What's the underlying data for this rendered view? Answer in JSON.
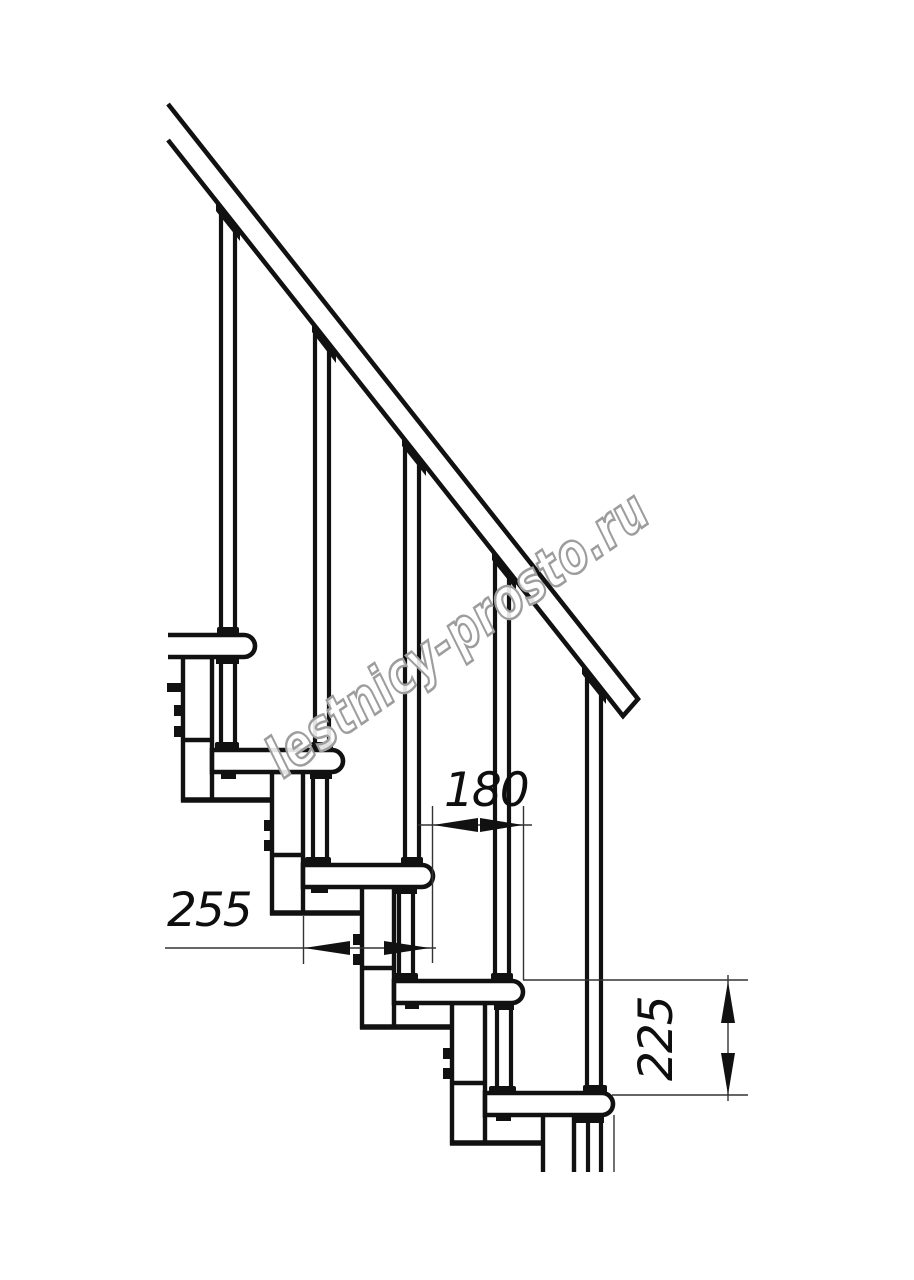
{
  "drawing": {
    "watermark": "lestnicy-prosto.ru",
    "dimensions": [
      {
        "id": "dim-180",
        "value": "180",
        "orientation": "horizontal"
      },
      {
        "id": "dim-255",
        "value": "255",
        "orientation": "horizontal"
      },
      {
        "id": "dim-225",
        "value": "225",
        "orientation": "vertical"
      }
    ],
    "structure": {
      "steps_visible": 5,
      "balusters_visible": 5
    },
    "colors": {
      "line": "#111111",
      "thin_line": "#333333",
      "text": "#0e0e0e",
      "watermark_outline": "#9d9d9d",
      "background": "#ffffff"
    }
  }
}
